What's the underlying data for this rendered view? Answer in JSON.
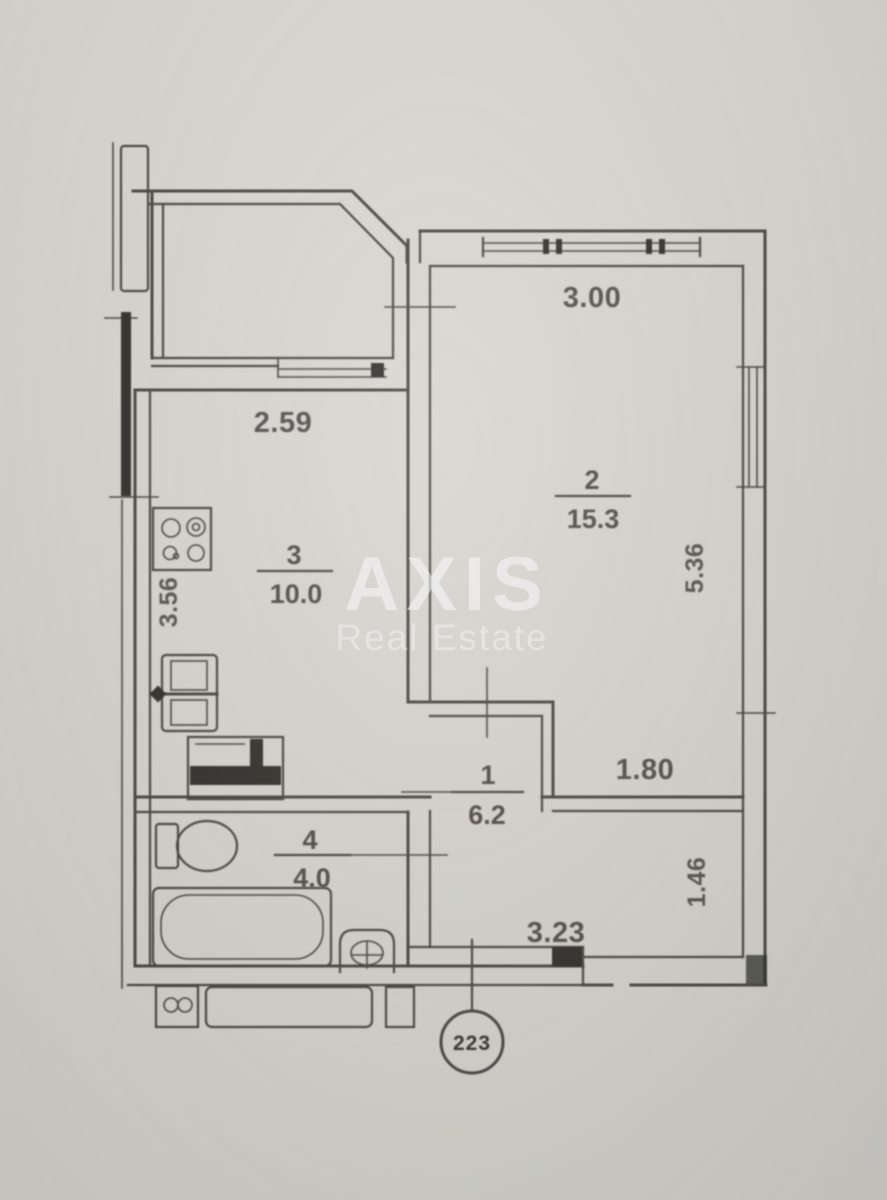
{
  "watermark": {
    "brand": "AXIS",
    "tagline": "Real Estate"
  },
  "apartment": {
    "unit_number": "223"
  },
  "rooms": {
    "living": {
      "number": "2",
      "area": "15.3"
    },
    "kitchen": {
      "number": "3",
      "area": "10.0"
    },
    "hallway": {
      "number": "1",
      "area": "6.2"
    },
    "bathroom": {
      "number": "4",
      "area": "4.0"
    }
  },
  "dimensions": {
    "living_width": "3.00",
    "kitchen_width": "2.59",
    "living_depth": "5.36",
    "kitchen_depth": "3.56",
    "living_lower_width": "1.80",
    "corridor_depth": "1.46",
    "entry_width": "3.23"
  },
  "icons": {
    "stove": "stove-icon",
    "fridge": "fridge-icon",
    "washer": "washer-icon",
    "toilet": "toilet-icon",
    "bathtub": "bathtub-icon",
    "sink": "sink-icon",
    "vent": "vent-icon"
  },
  "colors": {
    "paper": "#d6d2cd",
    "ink": "#44403b",
    "watermark": "#ffffff"
  }
}
